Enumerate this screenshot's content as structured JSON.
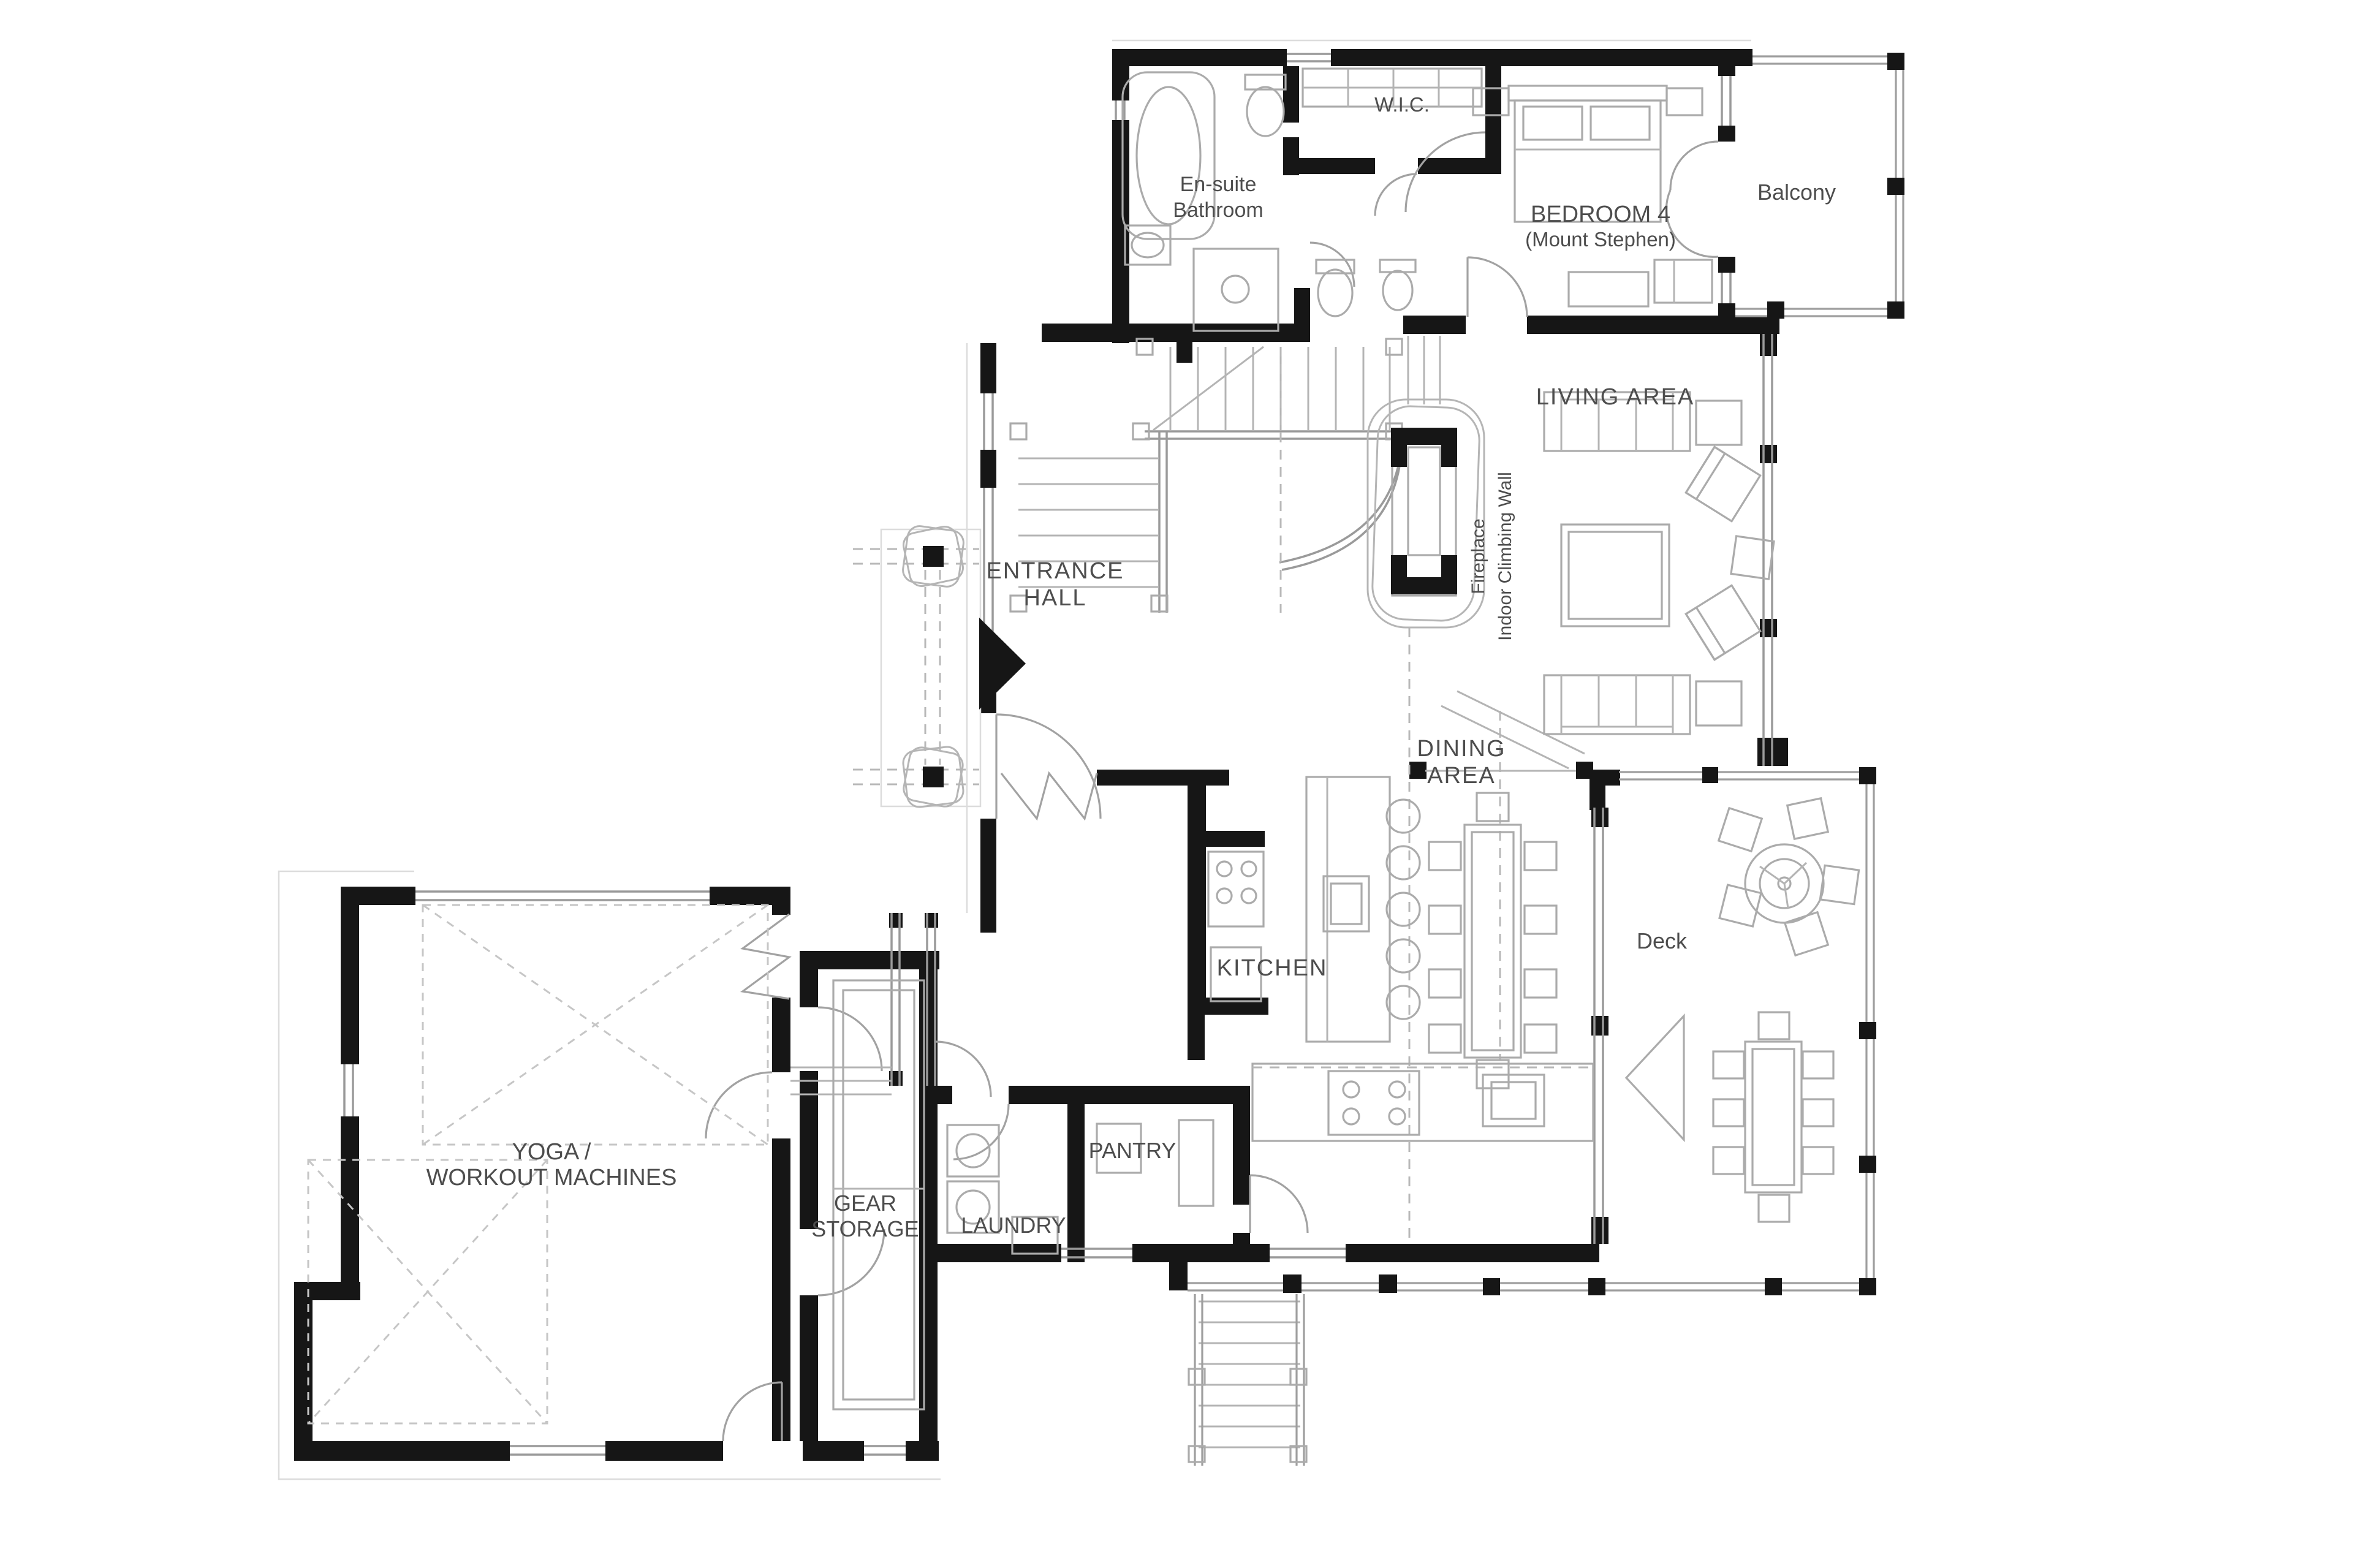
{
  "title": "Floor plan",
  "rooms": {
    "wic": {
      "label": "W.I.C."
    },
    "ensuite": {
      "line1": "En-suite",
      "line2": "Bathroom"
    },
    "bedroom4": {
      "line1": "BEDROOM 4",
      "line2": "(Mount Stephen)"
    },
    "balcony": {
      "label": "Balcony"
    },
    "living": {
      "label": "LIVING AREA"
    },
    "fireplace": {
      "label": "Fireplace"
    },
    "climbing_wall": {
      "label": "Indoor Climbing Wall"
    },
    "entrance": {
      "line1": "ENTRANCE",
      "line2": "HALL"
    },
    "dining": {
      "line1": "DINING",
      "line2": "AREA"
    },
    "kitchen": {
      "label": "KITCHEN"
    },
    "deck": {
      "label": "Deck"
    },
    "yoga": {
      "line1": "YOGA /",
      "line2": "WORKOUT MACHINES"
    },
    "gear": {
      "line1": "GEAR",
      "line2": "STORAGE"
    },
    "laundry": {
      "label": "LAUNDRY"
    },
    "pantry": {
      "label": "PANTRY"
    }
  },
  "colors": {
    "wall": "#161616",
    "label_text": "#4d4d4d",
    "thin_line": "#9a9a9a",
    "background": "#ffffff"
  }
}
